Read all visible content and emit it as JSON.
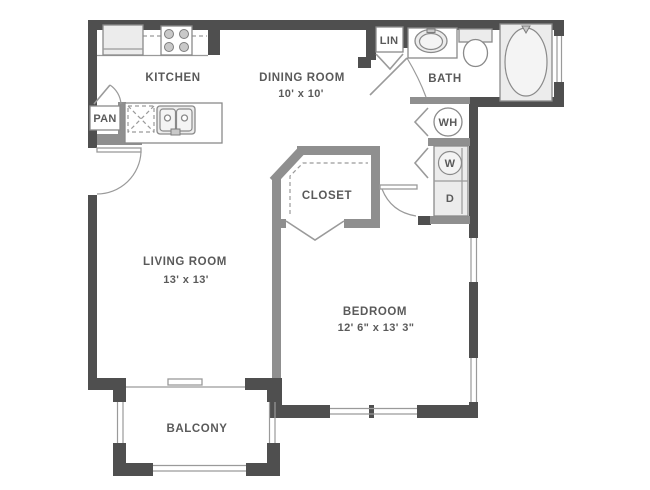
{
  "colors": {
    "wall_dark": "#4f4f4f",
    "wall_medium": "#8f8f8f",
    "line": "#9a9a9a",
    "fixture_fill": "#ececec",
    "fixture_line": "#8a8a8a",
    "text": "#5a5a5a"
  },
  "labels": {
    "kitchen": "KITCHEN",
    "dining_room": "DINING ROOM",
    "dining_dims": "10' x 10'",
    "living_room": "LIVING ROOM",
    "living_dims": "13' x 13'",
    "bedroom": "BEDROOM",
    "bedroom_dims": "12' 6\" x 13' 3\"",
    "bath": "BATH",
    "closet": "CLOSET",
    "balcony": "BALCONY",
    "pantry": "PAN",
    "linen": "LIN",
    "water_heater": "WH",
    "washer": "W",
    "dryer": "D"
  }
}
